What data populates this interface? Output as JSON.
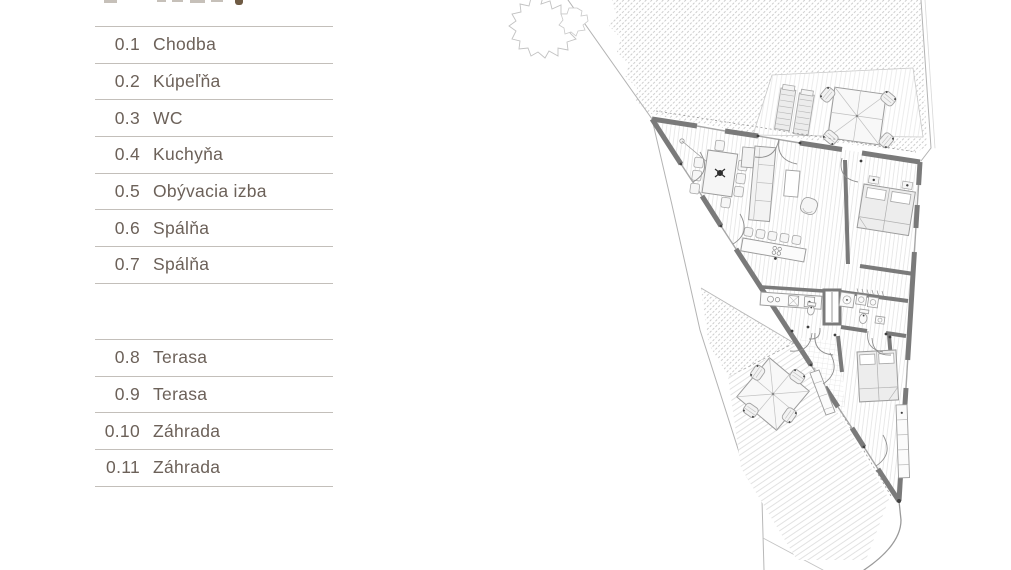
{
  "legend": {
    "rows": [
      {
        "no": "0.1",
        "name": "Chodba"
      },
      {
        "no": "0.2",
        "name": "Kúpeľňa"
      },
      {
        "no": "0.3",
        "name": "WC"
      },
      {
        "no": "0.4",
        "name": "Kuchyňa"
      },
      {
        "no": "0.5",
        "name": "Obývacia izba"
      },
      {
        "no": "0.6",
        "name": "Spálňa"
      },
      {
        "no": "0.7",
        "name": "Spálňa"
      },
      {
        "no": "0.8",
        "name": "Terasa"
      },
      {
        "no": "0.9",
        "name": "Terasa"
      },
      {
        "no": "0.10",
        "name": "Záhrada"
      },
      {
        "no": "0.11",
        "name": "Záhrada"
      }
    ]
  },
  "colors": {
    "legend_text": "#6c6159",
    "legend_divider": "#c3bfba",
    "wall": "#7a7a7a",
    "boundary": "#b3b3b3",
    "garden_hatch": "#c0c0c0",
    "furniture_stroke": "#a2a2a2",
    "accent_dark": "#3f3f3f"
  }
}
